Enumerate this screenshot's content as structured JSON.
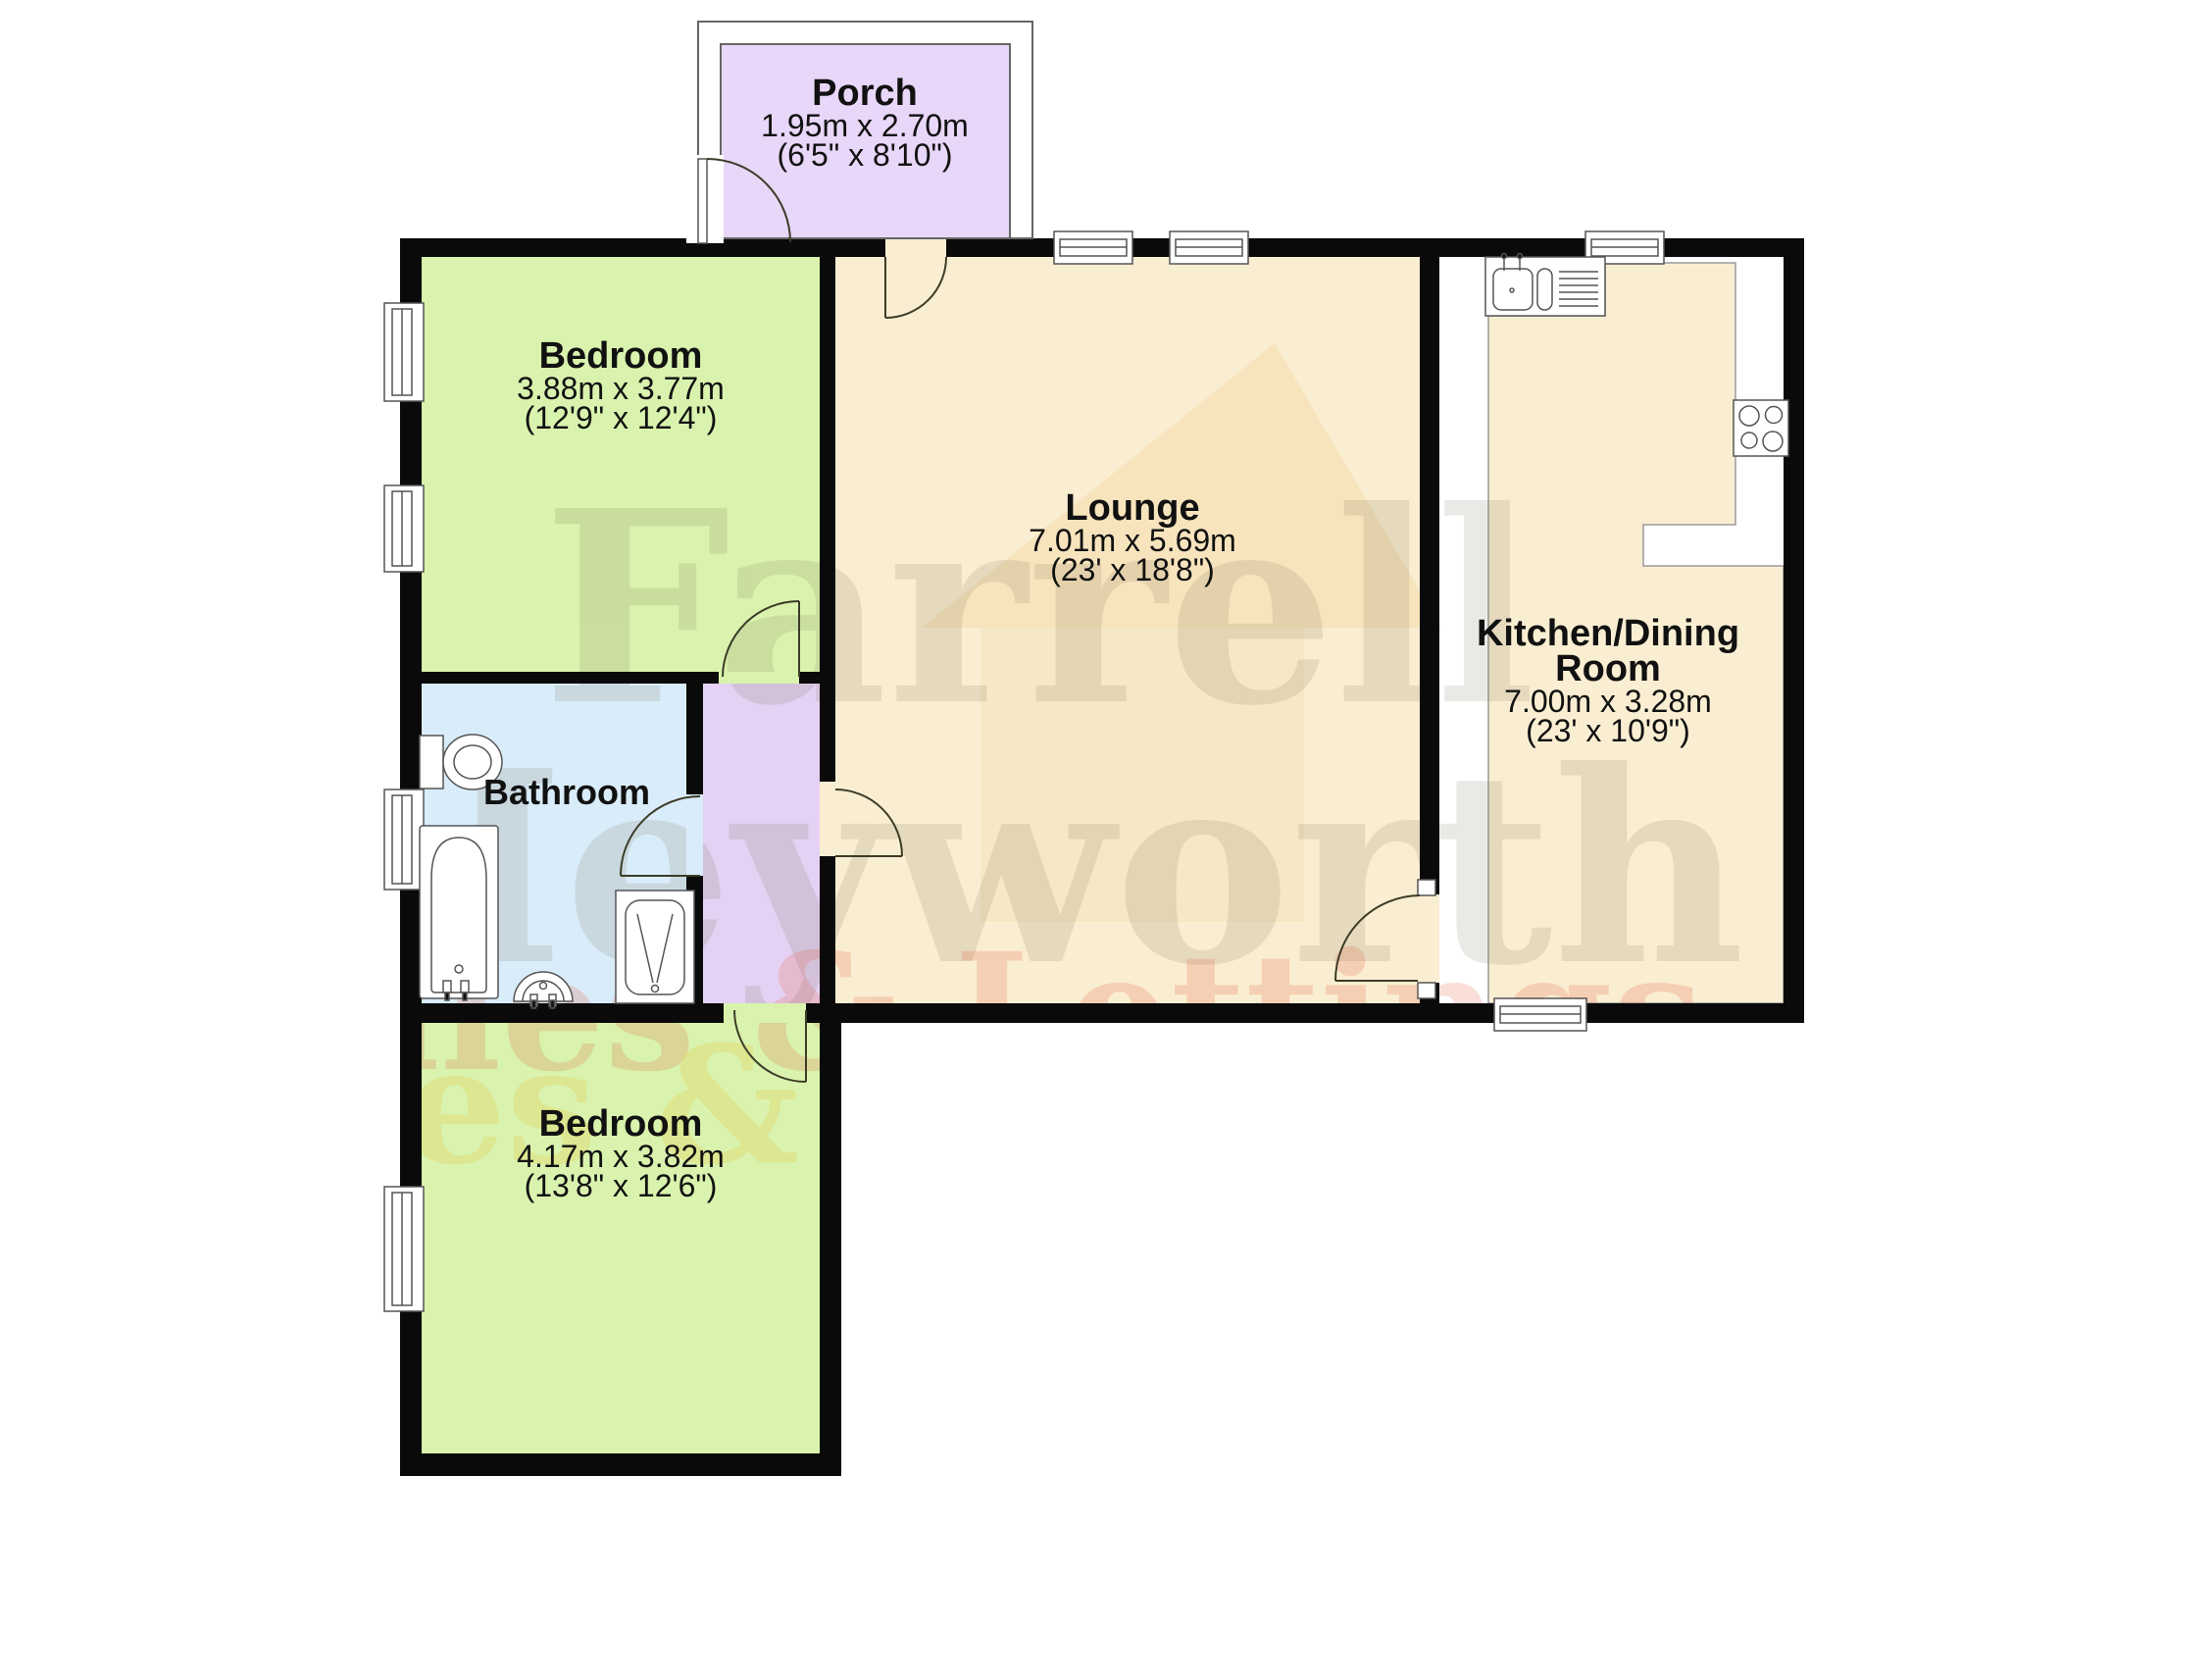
{
  "plan_title": "Bungalow floor plan",
  "watermark": {
    "line1": "Farrell",
    "line2": "Heyworth",
    "line3": "Sales & Lettings",
    "gray": "#6e614a",
    "pink": "#e65a3c",
    "yellow": "#e8c94e"
  },
  "colors": {
    "wall": "#0a0a0a",
    "bedroom_fill": "#d9f3ae",
    "bathroom_fill": "#d9ecf9",
    "hall_fill": "#e5d1f3",
    "porch_fill": "#e8d7f8",
    "lounge_fill": "#faeed2",
    "fixture_stroke": "#555555",
    "door_arc": "#3c3c28"
  },
  "rooms": {
    "porch": {
      "name": "Porch",
      "metric": "1.95m x 2.70m",
      "imperial": "(6'5\" x 8'10\")"
    },
    "bedroom1": {
      "name": "Bedroom",
      "metric": "3.88m x 3.77m",
      "imperial": "(12'9\" x 12'4\")"
    },
    "lounge": {
      "name": "Lounge",
      "metric": "7.01m x 5.69m",
      "imperial": "(23' x 18'8\")"
    },
    "kitchen": {
      "name": "Kitchen/Dining",
      "name2": "Room",
      "metric": "7.00m x 3.28m",
      "imperial": "(23' x 10'9\")"
    },
    "bathroom": {
      "name": "Bathroom"
    },
    "bedroom2": {
      "name": "Bedroom",
      "metric": "4.17m x 3.82m",
      "imperial": "(13'8\" x 12'6\")"
    }
  }
}
